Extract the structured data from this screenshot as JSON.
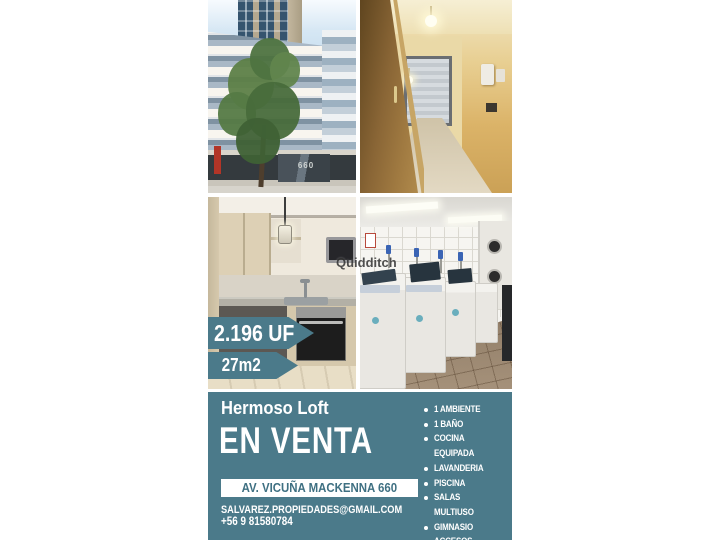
{
  "flyer": {
    "price_badge": "2.196 UF",
    "area_badge": "27m2",
    "title": "Hermoso Loft",
    "status": "EN VENTA",
    "address": "AV. VICUÑA MACKENNA 660",
    "contact": {
      "email": "SALVAREZ.PROPIEDADES@GMAIL.COM",
      "phone": "+56 9 81580784"
    },
    "features": {
      "items": [
        "1 AMBIENTE",
        "1 BAÑO",
        "COCINA EQUIPADA",
        "LAVANDERIA",
        "PISCINA",
        "SALAS MULTIUSO",
        "GIMNASIO",
        "ACCESOS CONTROLADOS"
      ]
    },
    "watermark": "Quidditch",
    "photos": {
      "building_sign": "660"
    },
    "colors": {
      "teal": "#4b7a8a",
      "text_on_teal": "#ffffff",
      "address_text": "#3f7082"
    }
  }
}
